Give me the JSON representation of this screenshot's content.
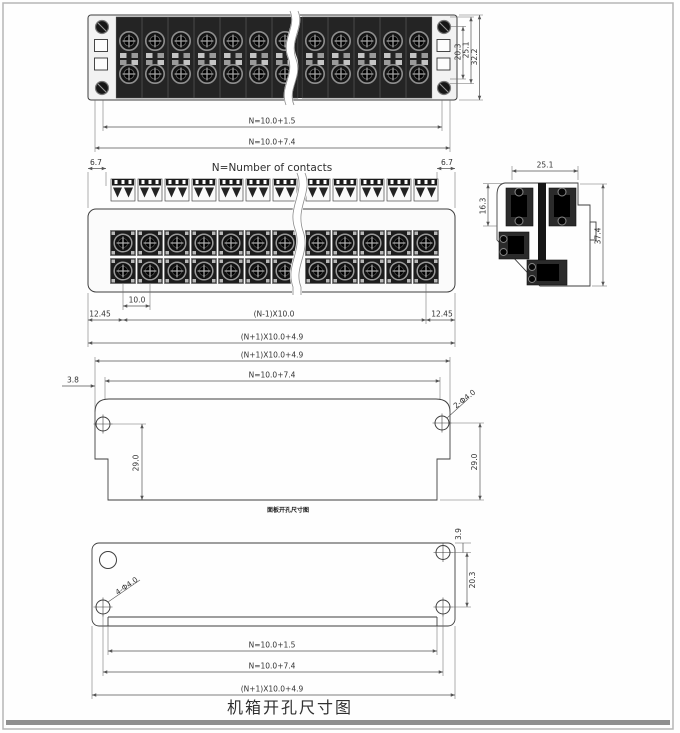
{
  "drawing": {
    "note_contacts": "N=Number of contacts",
    "caption_main": "机箱开孔尺寸图",
    "caption_sub": "面板开孔尺寸图",
    "colors": {
      "line": "#3f3f3f",
      "dark_fill": "#1f1f1f",
      "page_border": "#b5b5b5",
      "footer_bar": "#8f8f8f"
    },
    "front_view": {
      "dim_width_inner": "N=10.0+1.5",
      "dim_width_outer": "N=10.0+7.4",
      "dim_h_inner": "20.3",
      "dim_h_mid": "25.1",
      "dim_h_outer": "32.2"
    },
    "plan_view": {
      "dim_end": "6.7",
      "dim_pitch": "10.0",
      "dim_margin": "12.45",
      "dim_span": "(N-1)X10.0",
      "dim_overall": "(N+1)X10.0+4.9"
    },
    "side_view": {
      "dim_width": "25.1",
      "dim_upper": "16.3",
      "dim_height": "37.4"
    },
    "cutout_view": {
      "dim_overall": "(N+1)X10.0+4.9",
      "dim_inner": "N=10.0+7.4",
      "dim_edge": "3.8",
      "dim_holes": "2-Φ4.0",
      "dim_height": "29.0"
    },
    "chassis_view": {
      "dim_top": "3.9",
      "dim_hole_span": "20.3",
      "dim_holes": "4-Φ4.0",
      "dim_width_inner": "N=10.0+1.5",
      "dim_width_mid": "N=10.0+7.4",
      "dim_overall": "(N+1)X10.0+4.9"
    }
  }
}
